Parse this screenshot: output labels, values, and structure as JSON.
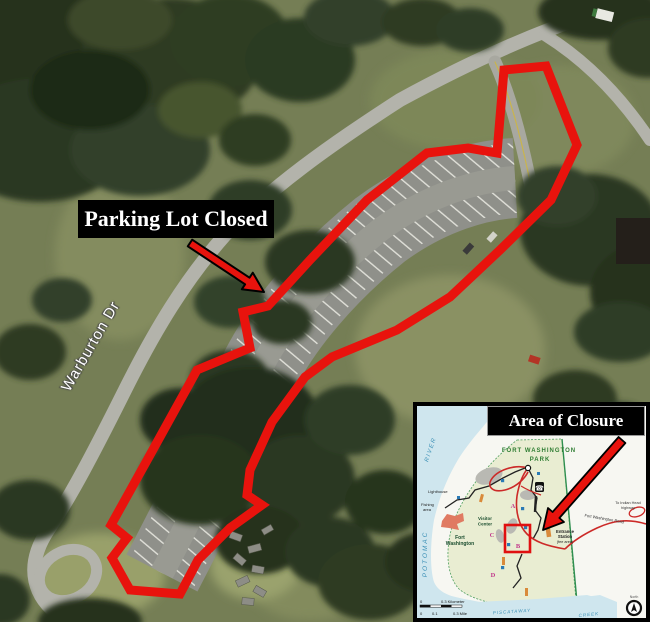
{
  "main": {
    "closed_label": "Parking Lot Closed",
    "street": "Warburton Dr"
  },
  "inset": {
    "title": "Area of Closure",
    "park_line1": "FORT WASHINGTON",
    "park_line2": "PARK",
    "potomac": "POTOMAC",
    "river": "RIVER",
    "piscataway": "PISCATAWAY",
    "creek": "CREEK",
    "visitor1": "Visitor",
    "visitor2": "Center",
    "fort1": "Fort",
    "fort2": "Washington",
    "entrance1": "Entrance",
    "entrance2": "Station",
    "entrance3": "(fee area)",
    "road_label": "Fort Washington Road",
    "hwy1": "To Indian Head",
    "hwy2": "highway",
    "lighthouse": "Lighthouse",
    "fishing1": "Fishing",
    "fishing2": "area",
    "north": "North",
    "phone_icon": "☎",
    "scale": {
      "km0": "0",
      "km": "0.3 Kilometer",
      "mi0": "0",
      "mi01": "0.1",
      "mi": "0.3 Mile"
    },
    "stops": {
      "a": "A",
      "b": "B",
      "c": "C",
      "d": "D"
    }
  },
  "colors": {
    "closure_red": "#e8130d",
    "water_blue": "#cfe6ee",
    "park_green": "#e9edd2",
    "boundary_green": "#2f8f4f",
    "road_red": "#cc2a28",
    "stop_magenta": "#c23a8c",
    "label_bg": "#000000",
    "label_text": "#ffffff"
  }
}
